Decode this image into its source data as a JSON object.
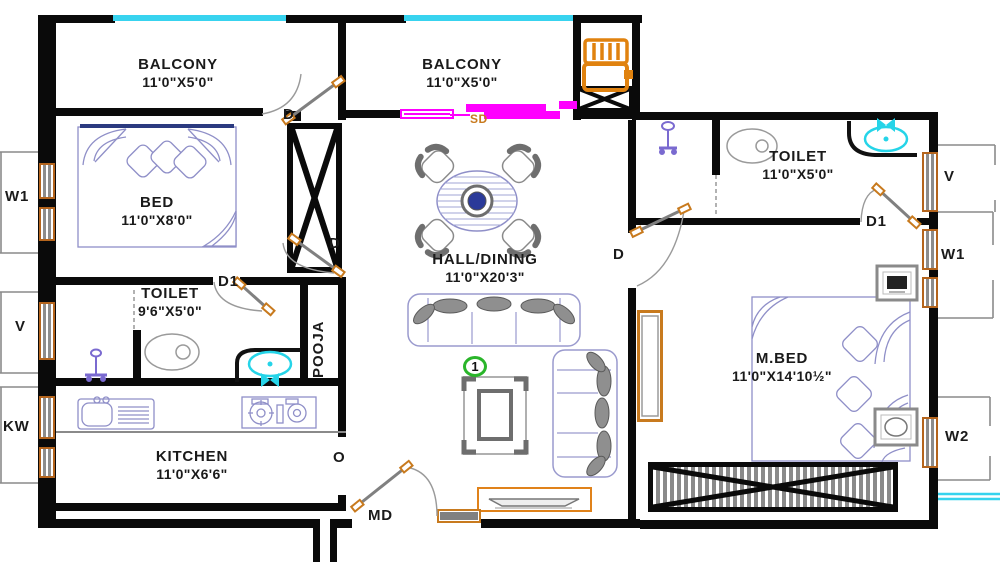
{
  "plan_type": "apartment-floor-plan",
  "rooms": {
    "balcony_left": {
      "name": "BALCONY",
      "size": "11'0\"X5'0\""
    },
    "balcony_mid": {
      "name": "BALCONY",
      "size": "11'0\"X5'0\""
    },
    "bed": {
      "name": "BED",
      "size": "11'0\"X8'0\""
    },
    "toilet_left": {
      "name": "TOILET",
      "size": "9'6\"X5'0\""
    },
    "pooja": {
      "name": "POOJA"
    },
    "kitchen": {
      "name": "KITCHEN",
      "size": "11'0\"X6'6\""
    },
    "hall": {
      "name": "HALL/DINING",
      "size": "11'0\"X20'3\""
    },
    "toilet_right": {
      "name": "TOILET",
      "size": "11'0\"X5'0\""
    },
    "master_bed": {
      "name": "M.BED",
      "size": "11'0\"X14'10½\""
    }
  },
  "openings": {
    "door": "D",
    "door1": "D1",
    "main_door": "MD",
    "sliding_door": "SD",
    "opening": "O"
  },
  "windows": {
    "window1": "W1",
    "ventilator": "V",
    "kitchen_window": "KW",
    "window2": "W2"
  },
  "annotations": {
    "unit_number": "1"
  },
  "legend_colors": {
    "walls": "#0a0a0a",
    "window_frame": "#b5651d",
    "railing": "#38d3ef",
    "sliding_door": "#ff00ff",
    "sanitary_fixture": "#25d4e8",
    "utility_fixture": "#e0820f",
    "furniture_outline": "#8f8fc8",
    "door_leaf": "#808080",
    "unit_marker": "#2ab52a"
  }
}
